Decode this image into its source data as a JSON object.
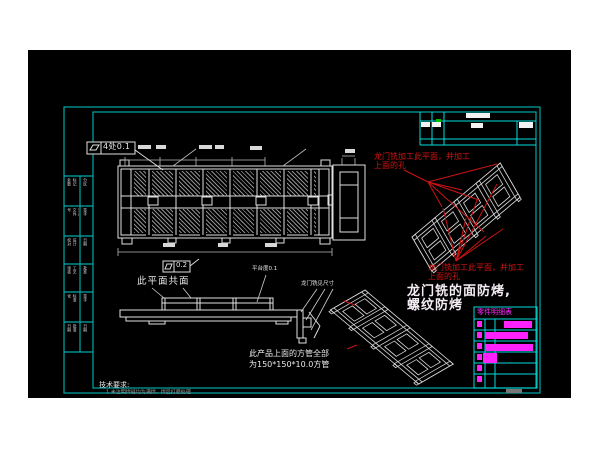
{
  "page": {
    "bg": "#ffffff",
    "canvas_bg": "#000000"
  },
  "colors": {
    "frame": "#00a8a8",
    "table_line": "#00dddd",
    "white_line": "#e0e0e0",
    "red": "#cc1414",
    "magenta": "#ff22ff",
    "green_mark": "#00c000"
  },
  "annotations": {
    "fcf_main": {
      "symbol": "flatness",
      "value": "4处0.1"
    },
    "fcf_small": {
      "symbol": "flatness",
      "value": "0.2"
    },
    "coplanar_note": "此平面共面",
    "platform_note": "平台度0.1",
    "gantry_dim_note": "龙门铣见尺寸",
    "red_note_top": {
      "line1": "龙门铣加工此平面，并加工",
      "line2": "上面的孔"
    },
    "red_note_bottom": {
      "line1": "龙门铣加工此平面，并加工",
      "line2": "上面的孔"
    },
    "milling_note": {
      "line1": "龙门铣的面防烤,",
      "line2": "螺纹防烤"
    },
    "tube_note": {
      "line1": "此产品上面的方管全部",
      "line2": "为150*150*10.0方管"
    },
    "tech_req": {
      "title": "技术要求:",
      "item1": "1.未注明焊缝均为满焊，焊后打磨处理"
    }
  },
  "parts_table": {
    "header": "零件明细表"
  },
  "signature_strip": {
    "cells": [
      {
        "a": "标记处数",
        "b": "分区"
      },
      {
        "a": "更改文件号",
        "b": "签字"
      },
      {
        "a": "设计校对",
        "b": "日期"
      },
      {
        "a": "工艺审核",
        "b": "批准"
      },
      {
        "a": "标准化",
        "b": "签字"
      },
      {
        "a": "批准日期",
        "b": "日期"
      }
    ]
  }
}
